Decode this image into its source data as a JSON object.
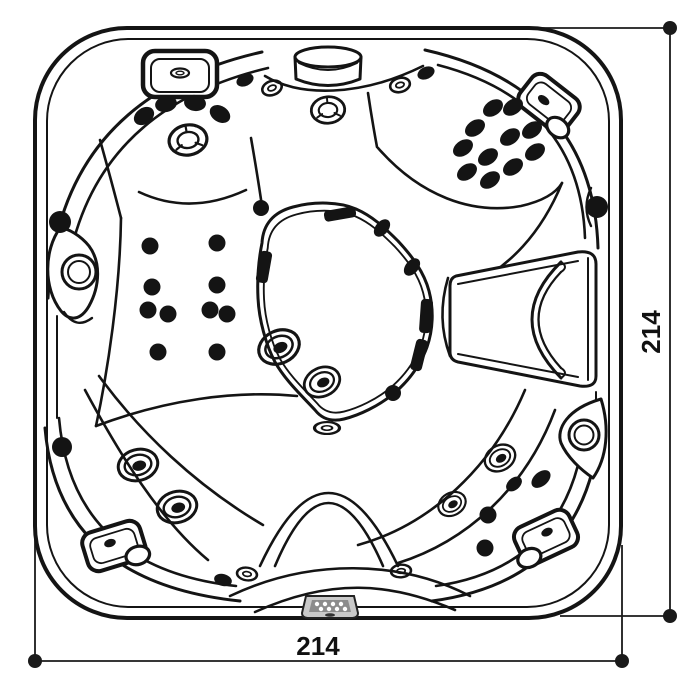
{
  "meta": {
    "title": "Hot tub plan view - dimensioned technical line drawing",
    "view": "top view"
  },
  "colors": {
    "line": "#141414",
    "background": "#ffffff",
    "panel_light": "#c9c9c9",
    "panel_dark": "#8c8c8c"
  },
  "dimensions": {
    "bottom_label": "214",
    "right_label": "214"
  },
  "features": {
    "headrests": [
      "top-left",
      "top-right",
      "bottom-left",
      "bottom-right"
    ],
    "control_panel_position": "bottom-center",
    "knob_position": "top-center",
    "waterfall_position": "right-middle",
    "corner_fittings": [
      "left-middle",
      "lower-right"
    ],
    "footwell": "center"
  },
  "jets": {
    "dark_ovals": [
      [
        144,
        116,
        -35,
        11,
        8
      ],
      [
        166,
        104,
        -12,
        11,
        8
      ],
      [
        195,
        103,
        8,
        11,
        8
      ],
      [
        220,
        114,
        32,
        11,
        8
      ],
      [
        245,
        80,
        -25,
        9,
        6
      ],
      [
        426,
        73,
        -25,
        9,
        6
      ],
      [
        493,
        108,
        -35,
        11,
        7.5
      ],
      [
        513,
        107,
        -35,
        11,
        7.5
      ],
      [
        532,
        130,
        -35,
        11,
        7.5
      ],
      [
        535,
        152,
        -35,
        11,
        7.5
      ],
      [
        513,
        167,
        -35,
        11,
        7.5
      ],
      [
        490,
        180,
        -35,
        11,
        7.5
      ],
      [
        467,
        172,
        -35,
        11,
        7.5
      ],
      [
        463,
        148,
        -35,
        11,
        7.5
      ],
      [
        475,
        128,
        -35,
        11,
        7.5
      ],
      [
        510,
        137,
        -35,
        11,
        7.5
      ],
      [
        488,
        157,
        -35,
        11,
        7.5
      ],
      [
        382,
        228,
        -50,
        10,
        6.5
      ],
      [
        412,
        267,
        -50,
        10,
        6.5
      ],
      [
        541,
        479,
        -40,
        11,
        7
      ],
      [
        514,
        484,
        -40,
        9,
        6
      ],
      [
        223,
        580,
        15,
        9,
        6
      ]
    ],
    "dots": [
      [
        150,
        246,
        8.5
      ],
      [
        217,
        243,
        8.5
      ],
      [
        152,
        287,
        8.5
      ],
      [
        217,
        285,
        8.5
      ],
      [
        148,
        310,
        8.5
      ],
      [
        168,
        314,
        8.5
      ],
      [
        210,
        310,
        8.5
      ],
      [
        227,
        314,
        8.5
      ],
      [
        158,
        352,
        8.5
      ],
      [
        217,
        352,
        8.5
      ],
      [
        60,
        222,
        11
      ],
      [
        62,
        447,
        10
      ],
      [
        597,
        207,
        11
      ],
      [
        261,
        208,
        8
      ],
      [
        393,
        393,
        8
      ],
      [
        488,
        515,
        8.5
      ],
      [
        485,
        548,
        8.5
      ]
    ],
    "rect_nozzles": [
      [
        340,
        214,
        32,
        11,
        -10
      ],
      [
        264,
        267,
        12,
        32,
        10
      ],
      [
        426,
        316,
        12,
        34,
        4
      ],
      [
        419,
        355,
        12,
        32,
        14
      ]
    ],
    "open_rings": [
      [
        272,
        88,
        -20,
        1,
        1
      ],
      [
        400,
        85,
        -15,
        1,
        1
      ],
      [
        247,
        574,
        8,
        1,
        0.9
      ],
      [
        401,
        571,
        -5,
        1,
        0.9
      ],
      [
        327,
        428,
        0,
        1.25,
        0.85
      ]
    ],
    "swirl_jets": [
      [
        279,
        347,
        -25,
        1.05
      ],
      [
        322,
        382,
        -25,
        0.92
      ],
      [
        138,
        465,
        -15,
        1.0
      ],
      [
        177,
        507,
        -15,
        1.0
      ],
      [
        500,
        458,
        -30,
        0.8
      ],
      [
        452,
        504,
        -30,
        0.72
      ]
    ],
    "spoke_jets": [
      [
        188,
        140,
        -10,
        1.0
      ],
      [
        328,
        110,
        -5,
        0.88
      ]
    ]
  }
}
